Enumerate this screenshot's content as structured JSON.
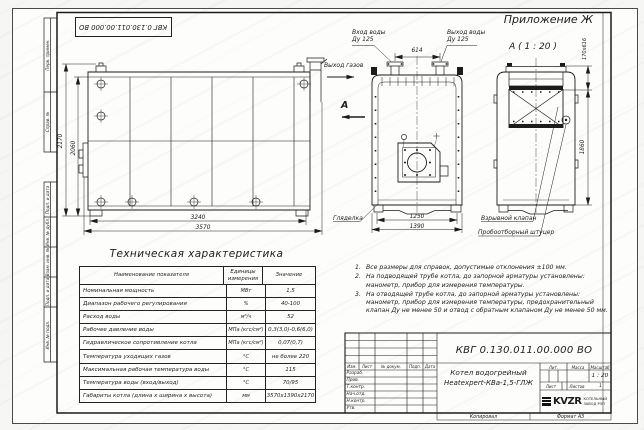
{
  "colors": {
    "line": "#1c1c1c",
    "paper": "#fdfdfb"
  },
  "frame": {
    "top_stamp": "КВГ 0.130.011.00.000 ВО",
    "left_fields": [
      "Перв. примен.",
      "Справ. №",
      "Подп. и дата",
      "Инв. № дубл.",
      "Взам. инв. №",
      "Подп. и дата",
      "Инв. № подл."
    ],
    "kopiroval": "Копировал",
    "format": "Формат А3"
  },
  "header": {
    "appendix": "Приложение Ж",
    "view_label": "А ( 1 : 20 )"
  },
  "annotations": {
    "water_inlet_line1": "Вход воды",
    "water_inlet_line2": "Ду 125",
    "water_outlet_line1": "Выход воды",
    "water_outlet_line2": "Ду 125",
    "gas_outlet": "Выход газов",
    "view_arrow": "А",
    "sight_glass": "Гляделка",
    "explosion_valve": "Взрывной клапан",
    "sampling_fitting": "Пробоотборный штуцер"
  },
  "dimensions": {
    "total_height": "2170",
    "body_height": "2060",
    "body_length": "3240",
    "total_length": "3570",
    "nozzle_spacing": "614",
    "body_width": "1250",
    "total_width": "1390",
    "rear_height": "1860",
    "valve_opening": "170х616"
  },
  "spec_table": {
    "title": "Техническая характеристика",
    "headers": {
      "name": "Наименование показателя",
      "unit": "Единицы измерения",
      "value": "Значение"
    },
    "rows": [
      {
        "name": "Номинальная мощность",
        "unit": "МВт",
        "value": "1,5"
      },
      {
        "name": "Диапазон рабочего регулирования",
        "unit": "%",
        "value": "40-100"
      },
      {
        "name": "Расход воды",
        "unit": "м³/ч",
        "value": "52"
      },
      {
        "name": "Рабочее давление воды",
        "unit": "МПа (кгс/см²)",
        "value": "0,3(3,0)-0,6(6,0)"
      },
      {
        "name": "Гидравлическое сопротивление котла",
        "unit": "МПа (кгс/см²)",
        "value": "0,07(0,7)"
      },
      {
        "name": "Температура уходящих газов",
        "unit": "°С",
        "value": "не более 220"
      },
      {
        "name": "Максимальная рабочая температура воды",
        "unit": "°С",
        "value": "115"
      },
      {
        "name": "Температура воды (вход/выход)",
        "unit": "°С",
        "value": "70/95"
      },
      {
        "name": "Габариты котла (длина х ширина х высота)",
        "unit": "мм",
        "value": "3570х1390х2170"
      }
    ]
  },
  "notes": {
    "items": [
      {
        "num": "1.",
        "text": "Все размеры для справок, допустимые отклонения ±100 мм."
      },
      {
        "num": "2.",
        "text": "На подводящей трубе котла, до запорной арматуры установлены: манометр, прибор для измерения температуры."
      },
      {
        "num": "3.",
        "text": "На отводящей трубе котла, до запорной арматуры установлены: манометр, прибор для измерения температуры, предохранительный клапан Ду не менее 50 и отвод с обратным клапаном Ду не менее 50 мм."
      }
    ]
  },
  "title_block": {
    "doc_number": "КВГ 0.130.011.00.000 ВО",
    "product_line1": "Котел водогрейный",
    "product_line2": "Heatexpert-КВа-1,5-ГЛЖ",
    "header_cols": [
      "Изм.",
      "Лист",
      "№ докум.",
      "Подп.",
      "Дата"
    ],
    "sig_rows": [
      "Разраб.",
      "Пров.",
      "Т.контр.",
      "Нач.отд.",
      "Н.контр.",
      "Утв."
    ],
    "lit_label": "Лит.",
    "mass_label": "Масса",
    "scale_label": "Масштаб",
    "scale_value": "1 : 20",
    "sheet_label": "Лист",
    "sheets_label": "Листов",
    "sheets_value": "1",
    "logo_text": "KVZR",
    "logo_sub1": "КОТЕЛЬНЫЙ",
    "logo_sub2": "ЗАВОД РЭП"
  }
}
